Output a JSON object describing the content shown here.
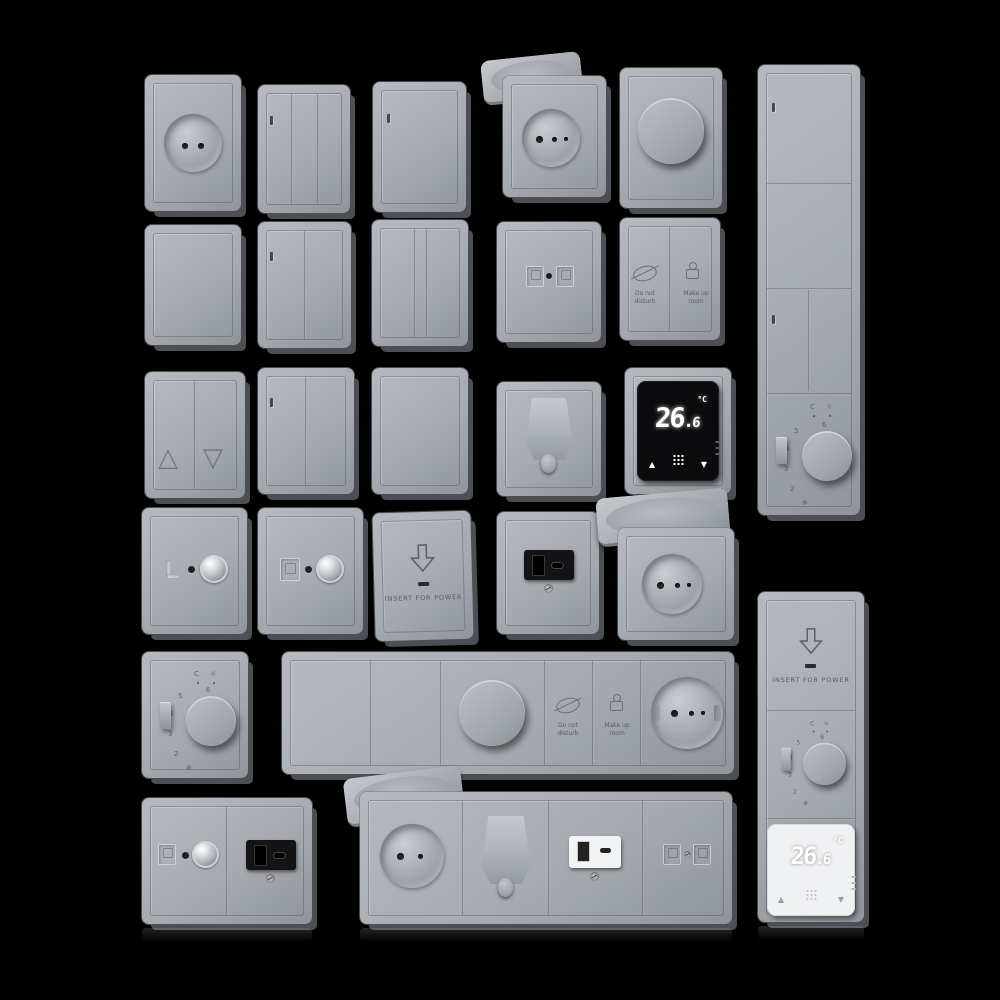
{
  "scene": {
    "description": "3D render catalog of grey wall switches, sockets and thermostats on black background",
    "background_color": "#000000",
    "plate_color": "#a6abb1",
    "plate_side_color": "#4c5055",
    "module_black_color": "#0b0b0d",
    "module_white_color": "#f0f1f2",
    "display_digit_color": "#ffffff"
  },
  "devices": {
    "thermostat": {
      "temp_whole": "26",
      "temp_decimal": "6",
      "unit": "°C",
      "up": "▲",
      "down": "▼"
    },
    "card": {
      "label": "INSERT FOR POWER"
    },
    "hotel": {
      "dnd": "Do not disturb",
      "mur": "Make up room"
    },
    "dial": {
      "marks": [
        "C",
        "☼"
      ],
      "scale": [
        "6",
        "5",
        "4",
        "3",
        "2"
      ],
      "frost": "❄"
    },
    "blinds": {
      "up": "△",
      "down": "▽"
    }
  }
}
